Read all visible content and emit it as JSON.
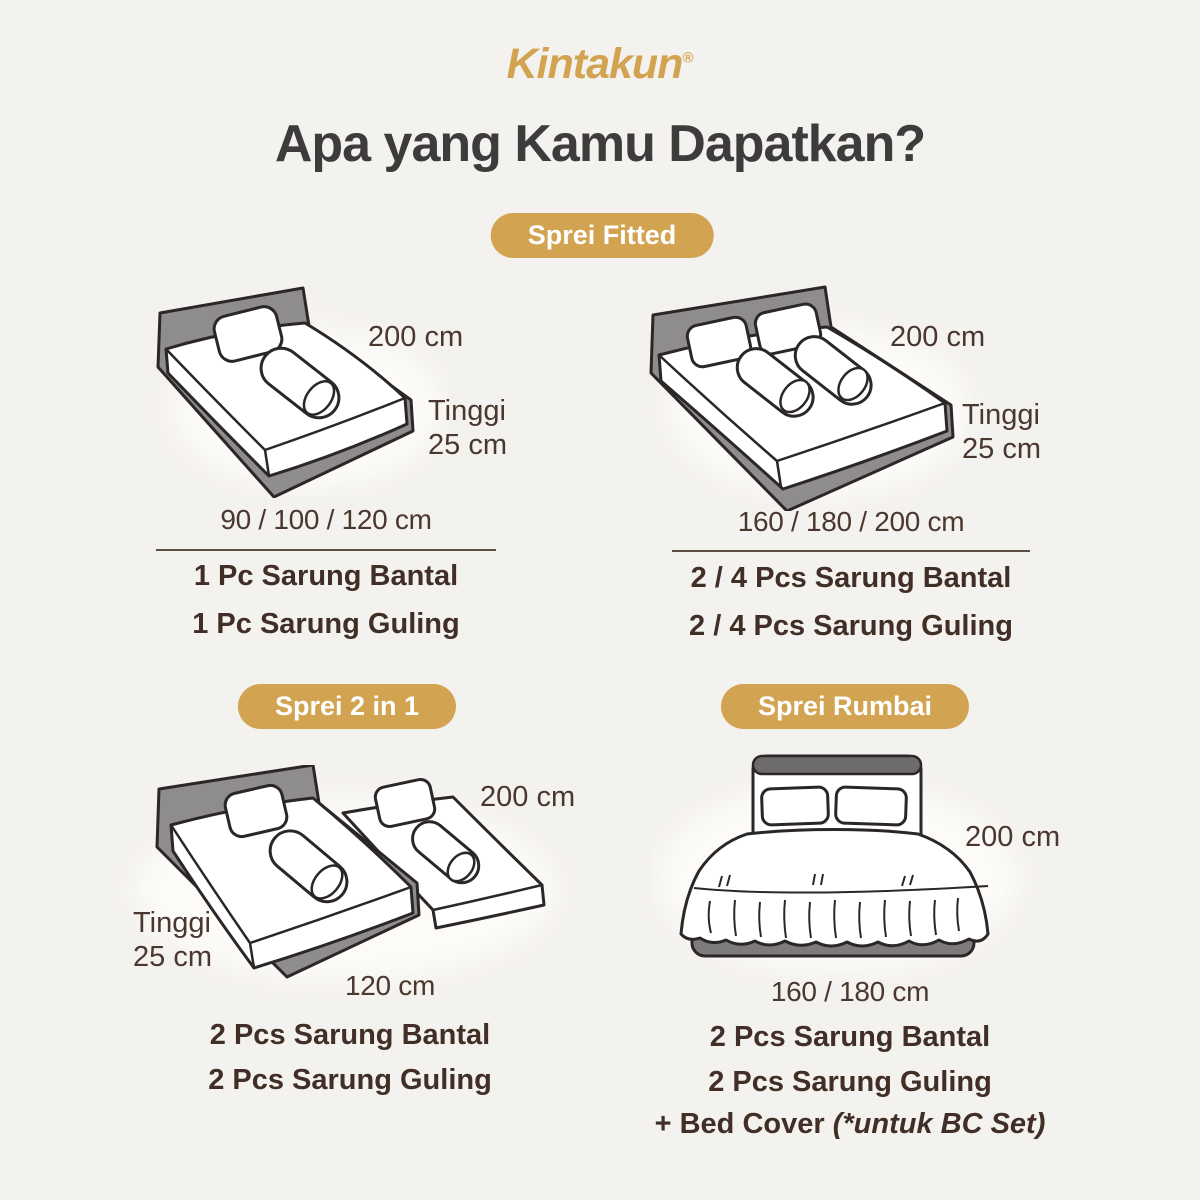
{
  "brand": {
    "logo_text": "Kintakun",
    "registered_mark": "®"
  },
  "title": "Apa yang Kamu Dapatkan?",
  "colors": {
    "background": "#f4f2ee",
    "gold": "#d2a350",
    "title_text": "#3e3b3c",
    "body_text": "#4a372f",
    "item_text": "#402e27",
    "illustration_line": "#2b2627"
  },
  "sections": {
    "fitted": {
      "badge_label": "Sprei Fitted",
      "left": {
        "length_label": "200 cm",
        "height_label_top": "Tinggi",
        "height_label_bottom": "25 cm",
        "sizes_label": "90 / 100 / 120 cm",
        "contents": [
          "1 Pc Sarung Bantal",
          "1 Pc Sarung Guling"
        ]
      },
      "right": {
        "length_label": "200 cm",
        "height_label_top": "Tinggi",
        "height_label_bottom": "25 cm",
        "sizes_label": "160 / 180 / 200 cm",
        "contents": [
          "2 / 4 Pcs Sarung Bantal",
          "2 / 4 Pcs Sarung Guling"
        ]
      }
    },
    "two_in_one": {
      "badge_label": "Sprei 2 in 1",
      "length_label": "200 cm",
      "height_label_top": "Tinggi",
      "height_label_bottom": "25 cm",
      "sizes_label": "120 cm",
      "contents": [
        "2 Pcs Sarung Bantal",
        "2 Pcs Sarung Guling"
      ]
    },
    "rumbai": {
      "badge_label": "Sprei Rumbai",
      "length_label": "200 cm",
      "sizes_label": "160 / 180 cm",
      "contents": [
        "2 Pcs Sarung Bantal",
        "2 Pcs Sarung Guling"
      ],
      "bonus_prefix": "+ Bed Cover ",
      "bonus_note": "(*untuk BC Set)"
    }
  }
}
